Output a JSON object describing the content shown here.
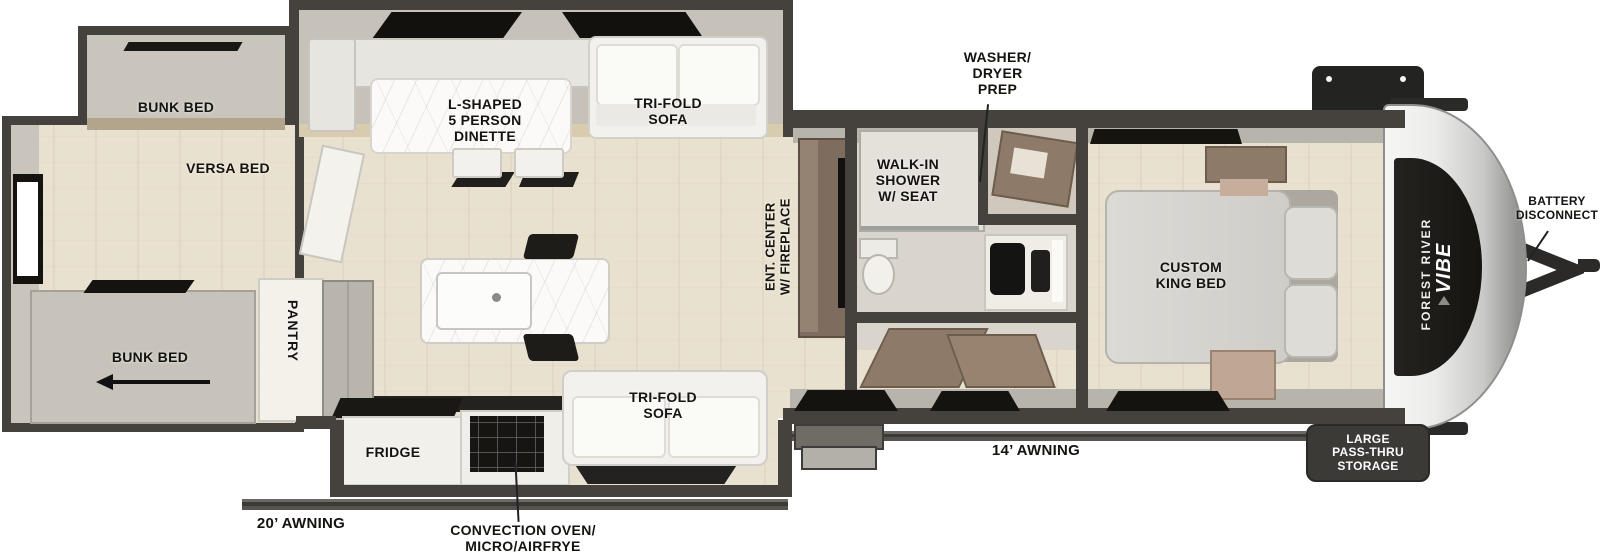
{
  "meta": {
    "description": "Top-down floor plan of a Forest River Vibe travel trailer with rear bunk room, L-shaped dinette slide-out, kitchen island, bath with walk-in shower, front custom king bedroom, hitch at right"
  },
  "colors": {
    "wall_dark": "#45423d",
    "wall_band": "#b7b4ac",
    "floor_beige": "#e9e1cf",
    "room_gray": "#c9c5bc",
    "bath_gray": "#d9d5cc",
    "white_furniture": "#f2f1ed",
    "wood_brown": "#8d7a69",
    "tan_accent": "#c0a694",
    "black": "#14130f",
    "cap_silver": "#c9c9c8",
    "decal_black": "#1e1d1b",
    "badge_dark": "#3b3a37"
  },
  "labels": {
    "bunk_top": "BUNK BED",
    "versa": "VERSA BED",
    "bunk_bottom": "BUNK BED",
    "pantry": "PANTRY",
    "dinette": "L-SHAPED\n5 PERSON\nDINETTE",
    "sofa_top": "TRI-FOLD\nSOFA",
    "washer": "WASHER/\nDRYER\nPREP",
    "shower": "WALK-IN\nSHOWER\nW/ SEAT",
    "ent_center": "ENT. CENTER\nW/ FIREPLACE",
    "king_bed": "CUSTOM\nKING BED",
    "fridge": "FRIDGE",
    "oven": "CONVECTION OVEN/\nMICRO/AIRFRYE",
    "sofa_bottom": "TRI-FOLD\nSOFA",
    "storage": "LARGE\nPASS-THRU\nSTORAGE",
    "battery": "BATTERY\nDISCONNECT",
    "awning_door": "14’ AWNING",
    "awning_rear": "20’ AWNING"
  },
  "brand": {
    "line1": "FOREST RIVER",
    "line2": "VIBE"
  }
}
